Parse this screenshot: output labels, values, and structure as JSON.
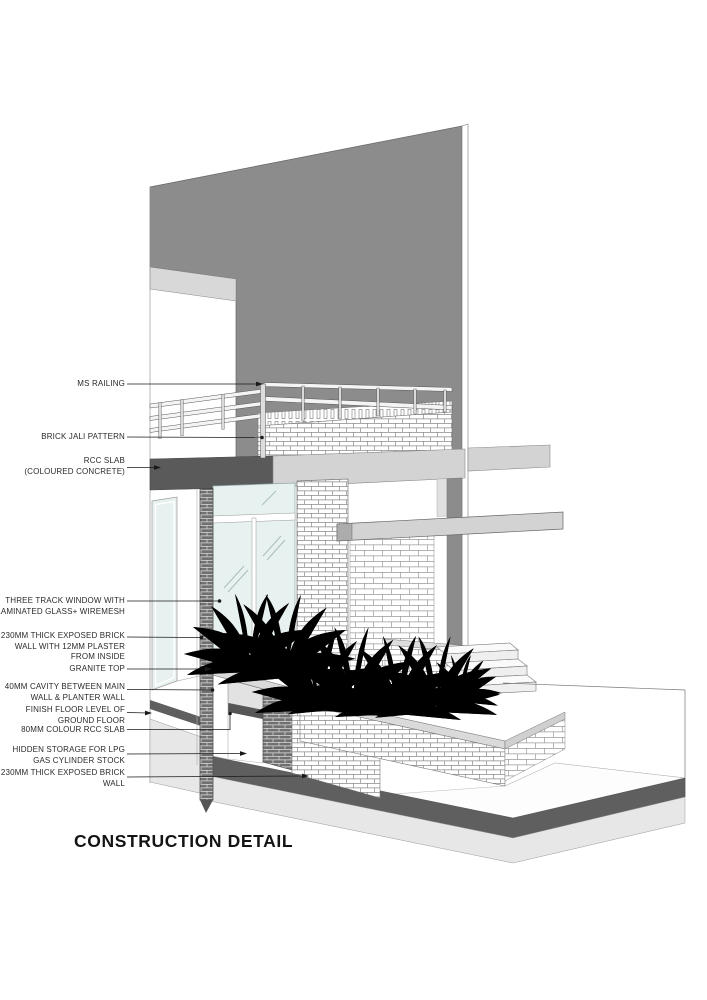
{
  "title": "CONSTRUCTION DETAIL",
  "annotations": {
    "ms_railing": {
      "lines": [
        "MS RAILING"
      ]
    },
    "brick_jali": {
      "lines": [
        "BRICK JALI PATTERN"
      ]
    },
    "rcc_slab": {
      "lines": [
        "RCC SLAB",
        "(COLOURED CONCRETE)"
      ]
    },
    "window": {
      "lines": [
        "THREE TRACK WINDOW WITH",
        "LAMINATED GLASS+ WIREMESH"
      ]
    },
    "brick_wall_plaster": {
      "lines": [
        "230MM THICK EXPOSED BRICK",
        "WALL WITH 12MM PLASTER",
        "FROM INSIDE"
      ]
    },
    "granite_top": {
      "lines": [
        "GRANITE TOP"
      ]
    },
    "cavity": {
      "lines": [
        "40MM CAVITY BETWEEN MAIN",
        "WALL & PLANTER WALL"
      ]
    },
    "ffl": {
      "lines": [
        "FINISH FLOOR LEVEL OF",
        "GROUND FLOOR"
      ]
    },
    "rcc_80": {
      "lines": [
        "80MM COLOUR RCC SLAB"
      ]
    },
    "storage": {
      "lines": [
        "HIDDEN STORAGE FOR LPG",
        "GAS CYLINDER STOCK"
      ]
    },
    "brick_wall_230": {
      "lines": [
        "230MM THICK EXPOSED BRICK",
        "WALL"
      ]
    }
  },
  "colors": {
    "facade_gray": "#8C8C8C",
    "slab_dark": "#5A5A5A",
    "slab_light": "#D3D3D3",
    "glass": "#E7F1F0",
    "ground_band": "#5F5F5F",
    "plinth": "#E7E7E7",
    "granite": "#DADADA",
    "plant": "#3F3F3F"
  }
}
